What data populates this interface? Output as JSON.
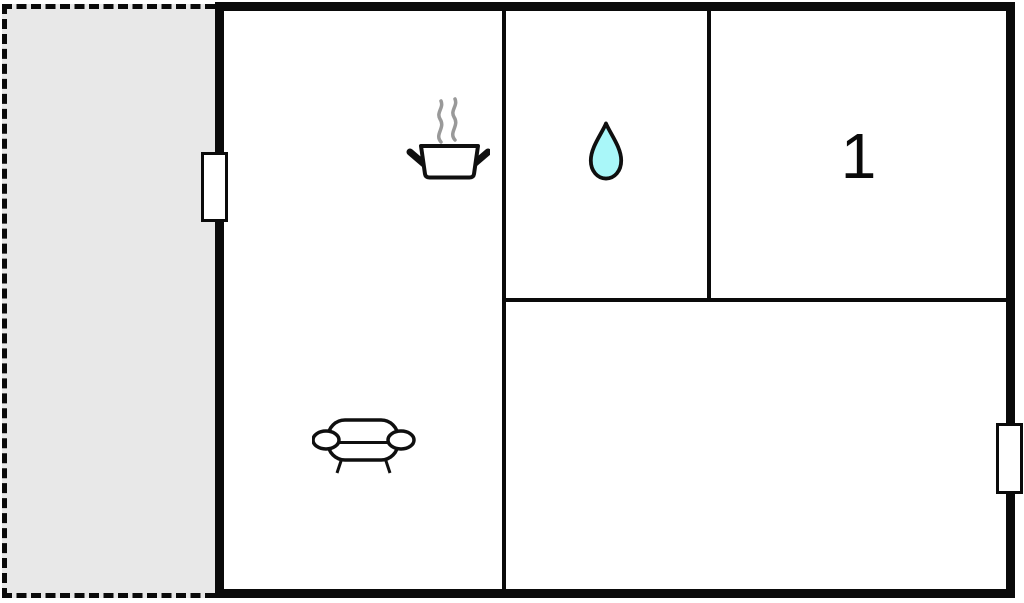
{
  "page": {
    "type": "floor-plan",
    "background": "#ffffff"
  },
  "colors": {
    "wall": "#0a0a0a",
    "terrace_fill": "#e8e8e8",
    "water_drop_fill": "#a9f7f9",
    "steam_gray": "#999999",
    "icon_stroke": "#0f0f0f",
    "window_fill": "#ffffff"
  },
  "floorplan": {
    "bedroom1_label": "1",
    "icons": {
      "kitchen_icon": "cooking-pot-icon",
      "bathroom_icon": "water-drop-icon",
      "lounge_icon": "sofa-icon"
    },
    "features": {
      "terrace": "dashed outdoor area",
      "openings": [
        "window-left-wall",
        "window-right-wall"
      ]
    }
  }
}
